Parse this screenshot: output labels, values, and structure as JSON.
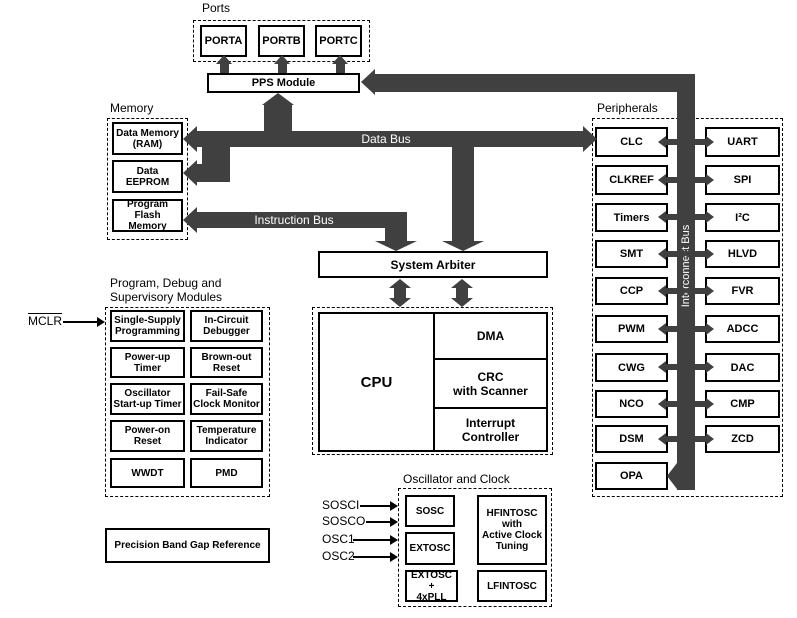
{
  "colors": {
    "bus": "#404040",
    "border": "#000000",
    "background": "#ffffff",
    "bus_text": "#ffffff"
  },
  "ports": {
    "label": "Ports",
    "items": [
      "PORTA",
      "PORTB",
      "PORTC"
    ]
  },
  "pps": {
    "label": "PPS Module"
  },
  "memory": {
    "label": "Memory",
    "ram": "Data Memory\n(RAM)",
    "eeprom": "Data\nEEPROM",
    "flash": "Program\nFlash Memory"
  },
  "buses": {
    "data": "Data Bus",
    "instruction": "Instruction Bus",
    "interconnect": "Interconnect Bus"
  },
  "arbiter": {
    "label": "System Arbiter"
  },
  "cpu": {
    "label": "CPU",
    "dma": "DMA",
    "crc": "CRC\nwith Scanner",
    "intc": "Interrupt\nController"
  },
  "debug": {
    "title": "Program, Debug and\nSupervisory Modules",
    "mclr": "MCLR",
    "cells": [
      "Single-Supply\nProgramming",
      "In-Circuit\nDebugger",
      "Power-up\nTimer",
      "Brown-out\nReset",
      "Oscillator\nStart-up Timer",
      "Fail-Safe\nClock Monitor",
      "Power-on\nReset",
      "Temperature\nIndicator",
      "WWDT",
      "PMD"
    ]
  },
  "bandgap": {
    "label": "Precision Band Gap Reference"
  },
  "peripherals": {
    "label": "Peripherals",
    "left": [
      "CLC",
      "CLKREF",
      "Timers",
      "SMT",
      "CCP",
      "PWM",
      "CWG",
      "NCO",
      "DSM",
      "OPA"
    ],
    "right": [
      "UART",
      "SPI",
      "I²C",
      "HLVD",
      "FVR",
      "ADCC",
      "DAC",
      "CMP",
      "ZCD"
    ]
  },
  "oscillator": {
    "label": "Oscillator and Clock",
    "signals": [
      "SOSCI",
      "SOSCO",
      "OSC1",
      "OSC2"
    ],
    "sosc": "SOSC",
    "extosc": "EXTOSC",
    "extosc_pll": "EXTOSC +\n4xPLL",
    "hfintosc": "HFINTOSC\nwith\nActive Clock\nTuning",
    "lfintosc": "LFINTOSC"
  }
}
